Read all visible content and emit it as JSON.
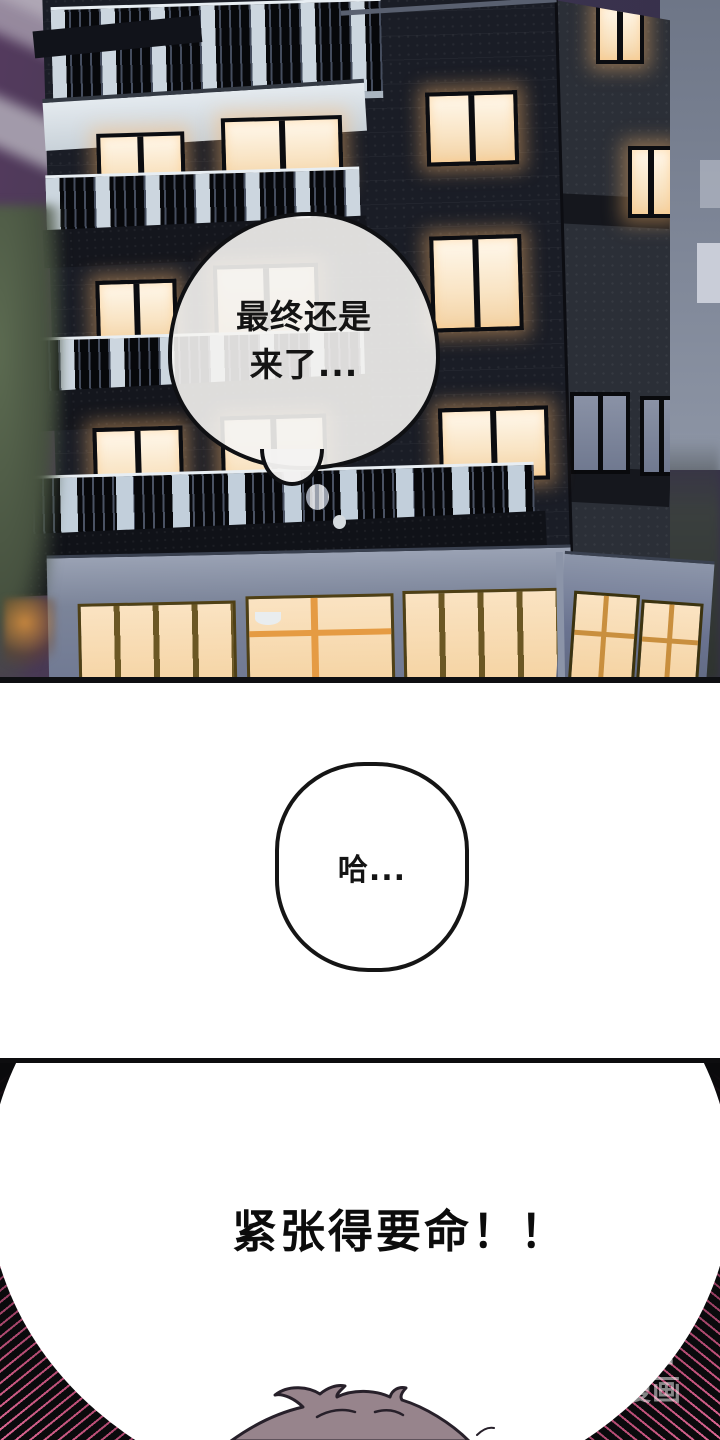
{
  "panel_building": {
    "thought_bubble": {
      "line1": "最终还是",
      "line2": "来了..."
    },
    "colors": {
      "sky_purple": "#543a5e",
      "sky_indigo": "#37304a",
      "wall_dark": "#1a1d26",
      "wall_side": "#2b2f37",
      "window_glow_warm": "#f8e2c0",
      "window_frame": "#0b0c10",
      "balcony_light": "#c9d3dd",
      "ground_wall": "#6e7792",
      "ground_window": "#f8ddb4",
      "foliage_green": "#55654c"
    }
  },
  "panel_sigh": {
    "bubble_text": "哈..."
  },
  "panel_shout": {
    "text": "紧张得要命！！",
    "colors": {
      "speedline_pink": "#e2688e",
      "speedline_black": "#0a0a0c",
      "hair": "#97848c"
    },
    "watermark": {
      "logo": "画涯",
      "tagline": "免费漫画"
    }
  }
}
